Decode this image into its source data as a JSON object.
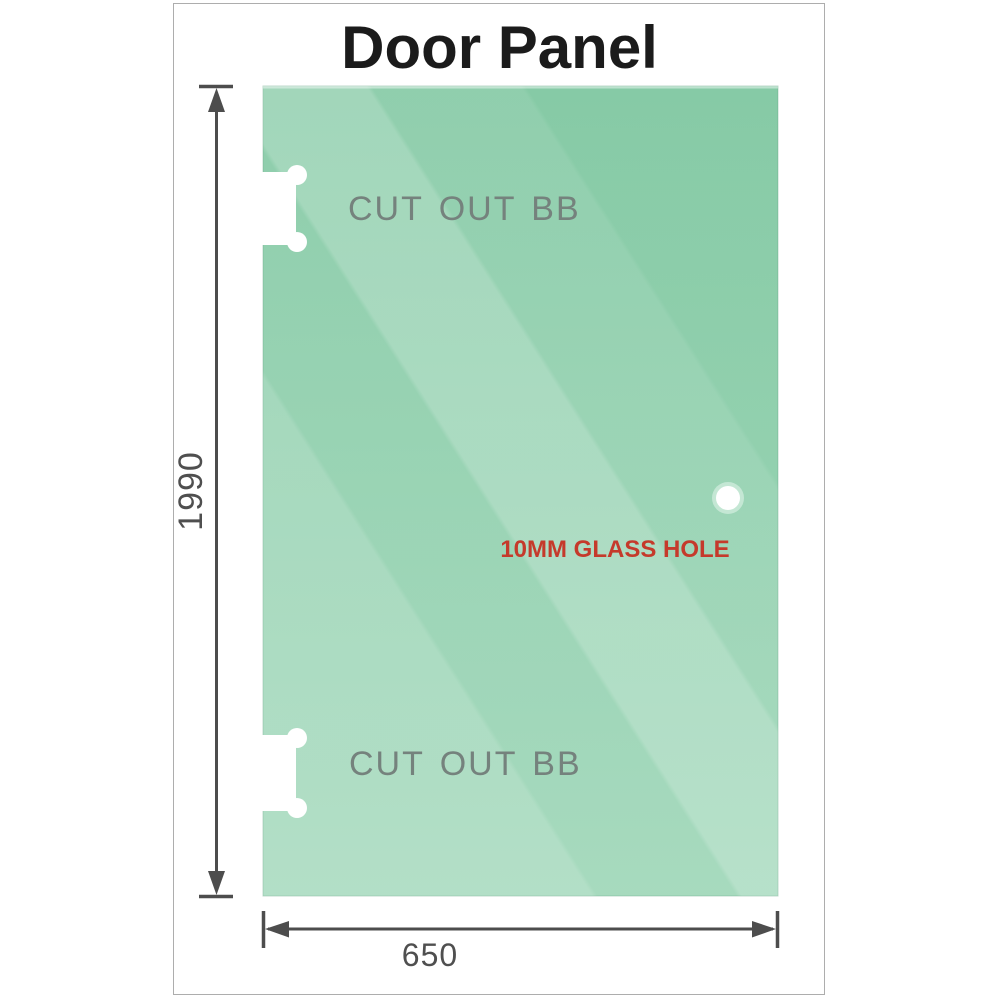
{
  "page": {
    "title": "Door Panel"
  },
  "panel": {
    "cutout_top_label": "CUT OUT BB",
    "cutout_bottom_label": "CUT OUT BB",
    "hole_label": "10MM GLASS HOLE"
  },
  "dimensions": {
    "height_mm": "1990",
    "width_mm": "650"
  },
  "colors": {
    "glass_top": "#81c8a2",
    "glass_bottom": "#9dd6b7",
    "glass_edge": "#6fba93",
    "hole_ring": "#c4e7d4",
    "hole_fill": "#ffffff",
    "cutout_fill": "#ffffff",
    "dimension_line": "#4d4d4d",
    "hole_label_red": "#c53a2b",
    "cutout_label_gray": "#75827d",
    "title_color": "#1b1b1b",
    "card_border": "#adadad"
  }
}
